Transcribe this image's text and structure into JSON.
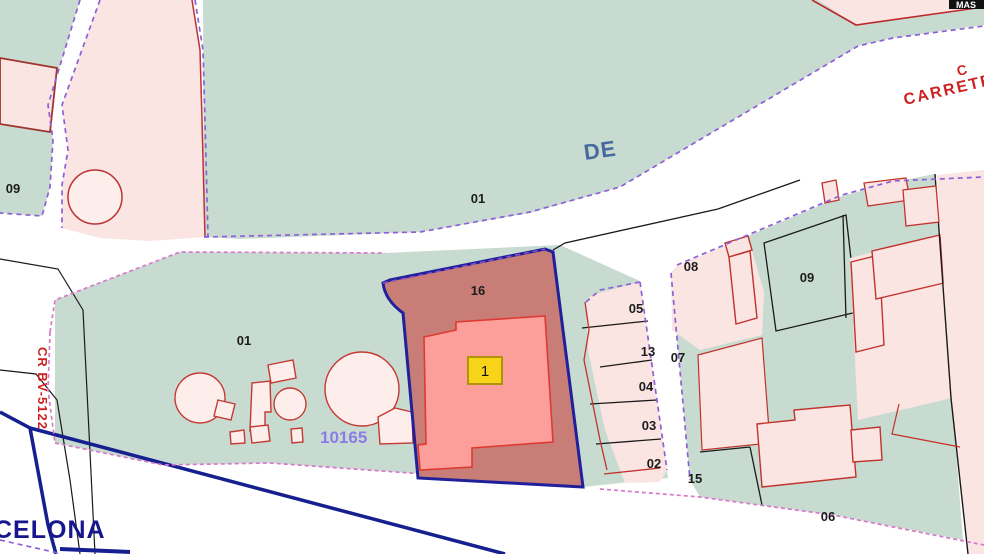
{
  "map": {
    "corner_box_label": "MAS",
    "road_label_top": "CARRETER",
    "road_label_top_partial": "C",
    "road_name_fragment": "DE",
    "road_label_left_rotated": "CR BV-5122",
    "municipality_label_partial": "CELONA",
    "reference_label": "10165",
    "highlight_badge": "1",
    "parcel_numbers": {
      "p09_left": "09",
      "p01_top": "01",
      "p16_highlight": "16",
      "p01_bottom": "01",
      "p05": "05",
      "p13": "13",
      "p04": "04",
      "p03": "03",
      "p02": "02",
      "p15": "15",
      "p07": "07",
      "p08": "08",
      "p09_right": "09",
      "p06": "06"
    }
  },
  "colors": {
    "urban_green": "#c8dbd1",
    "parcel_pink": "#fbe5e3",
    "tank_pink": "#fdeeec",
    "highlight_parcel_fill": "#c87d76",
    "highlight_parcel_border": "#20209b",
    "building_fill": "#fc9e9a",
    "building_border": "#dd3a32",
    "badge_yellow": "#f7d319",
    "badge_border": "#b0930a",
    "boundary_purple_dash": "#8f5fd6",
    "boundary_pink_dash": "#d879c9",
    "road_axis_navy": "#151f8f",
    "cadastral_red": "#c0322c",
    "label_blue": "#48699e",
    "label_purple": "#8b7be5",
    "label_red": "#cc2222",
    "label_navy": "#16178f",
    "line_black": "#1a1a1a"
  }
}
